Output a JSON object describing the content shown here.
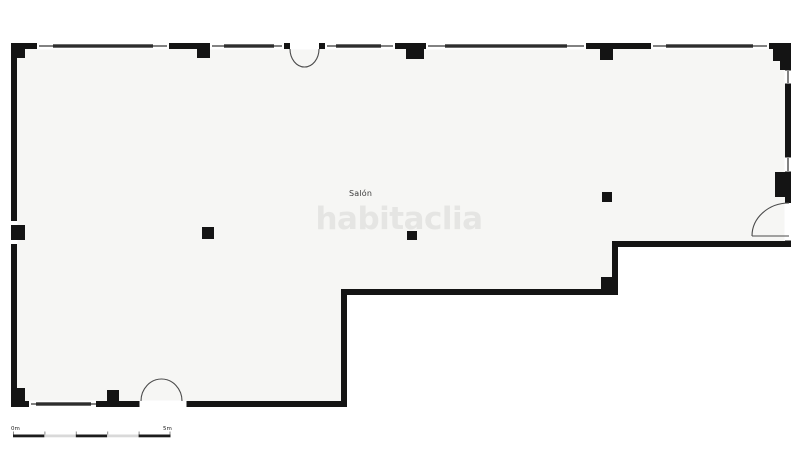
{
  "floorplan": {
    "room_label": "Salón",
    "watermark": "habitaclia",
    "scale_bar": {
      "start_label": "0m",
      "end_label": "5m"
    },
    "colors": {
      "wall": "#141414",
      "floor": "#f6f6f4",
      "window_bar": "#2e2e2e",
      "door_stroke": "#4a4a4a",
      "watermark": "#e5e5e3",
      "label": "#3c3c3c",
      "scale_dark": "#1c1c1c",
      "scale_light": "#d9d9d9",
      "scale_text": "#222222"
    }
  }
}
